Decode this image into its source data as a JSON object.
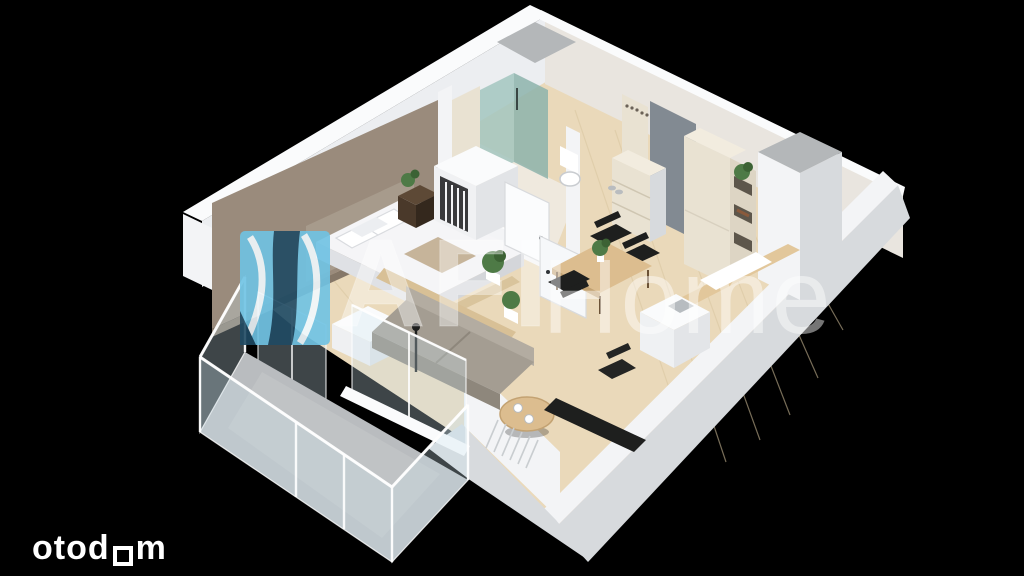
{
  "canvas": {
    "width": 1024,
    "height": 576
  },
  "branding": {
    "watermark": {
      "bold_text": "AFI",
      "light_text": "Home"
    },
    "portal_logo": {
      "text_before_square": "otod",
      "text_after_square": "m"
    }
  },
  "colors": {
    "pageBg": "#000000",
    "wall": "#f3f4f6",
    "wallTop": "#fafbfc",
    "wallInner": "#eceef1",
    "wallWarm": "#e9e5df",
    "wallShade": "#d7dadd",
    "accent": "#9a8b7c",
    "accentDark": "#857768",
    "headboard": "#a79b8c",
    "wood": "#ead9ba",
    "woodLine": "#d9c6a0",
    "tile": "#efe9de",
    "balconyFloor": "#b9bcbf",
    "balconyLight": "#c9cccd",
    "glassFill": "rgba(205,228,238,0.30)",
    "glassEdge": "rgba(255,255,255,0.8)",
    "shower": "#a3c6bf",
    "showerDark": "#8db3ac",
    "doorGray": "#828a92",
    "shaft": "#b4b7b9",
    "cream": "#e9e2d2",
    "creamShade": "#f2ecdf",
    "sofa": "#a49d92",
    "sofaLight": "#b3aca1",
    "sofaDark": "#8e877c",
    "bed": "#f5f5f7",
    "bedShade": "#dfe1e5",
    "tableWood": "#dcbd8f",
    "tableWoodDark": "#c3a272",
    "darkWood": "#4a392a",
    "darkWoodTop": "#5d4936",
    "black": "#1e1f1e",
    "plant": "#4e7a46",
    "plantDark": "#3c6234",
    "white": "#ffffff",
    "wmLightBlue": "#6fc3e4",
    "wmDarkBlue": "#1f4a63",
    "wmText": "rgba(255,255,255,0.40)",
    "wmTextLight": "rgba(255,255,255,0.46)",
    "otodomColor": "#ffffff"
  },
  "scene": {
    "type": "isometric-3d-floorplan-render",
    "rooms": [
      "bedroom",
      "bathroom",
      "entry-hall",
      "living-dining-room",
      "kitchenette",
      "balcony"
    ],
    "furniture": [
      "double-bed-with-white-bedding-and-pillows",
      "gray-headboard-panel",
      "taupe-accent-wall",
      "dark-nightstand-with-plant",
      "open-wardrobe-with-hanging-clothes",
      "glass-shower-cabin",
      "toilet",
      "bathroom-vanity",
      "gray-entry-door",
      "coat-hook-panel",
      "cream-drawer-chest",
      "tall-cabinet-with-open-shelves-plant-and-books",
      "wooden-dining-table-with-plant",
      "black-dining-chairs",
      "kitchen-island-with-sink",
      "wooden-kitchen-counter",
      "gray-sofa",
      "plant-shelf-behind-sofa",
      "round-coffee-table-with-two-cups",
      "black-desk-with-chair",
      "black-floor-lamp",
      "glass-balcony-railing-with-posts",
      "concrete-balcony-floor",
      "ventilation-shaft-north",
      "ventilation-shaft-east"
    ]
  }
}
